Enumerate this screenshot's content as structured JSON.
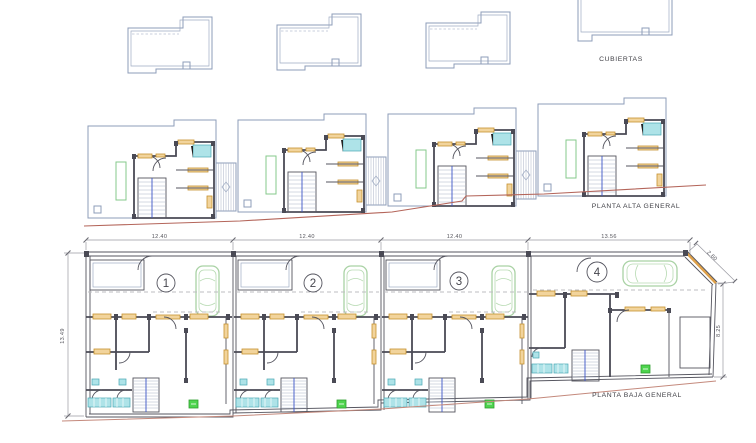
{
  "drawing": {
    "labels": {
      "roofs_plan": "CUBIERTAS",
      "upper_floor_plan": "PLANTA ALTA GENERAL",
      "ground_floor_plan": "PLANTA BAJA GENERAL"
    },
    "units": [
      "1",
      "2",
      "3",
      "4"
    ],
    "dimensions": {
      "unit_widths": [
        "12.40",
        "12.40",
        "12.40",
        "13.56"
      ],
      "left_depth": "13.49",
      "right_depth": "8.25",
      "chamfer": "2.60"
    },
    "icons": {
      "car": "top-view-car-outline",
      "stairs": "stair-tread-hatch",
      "unit_marker": "circled-number",
      "bath": "cyan-fixture",
      "planter": "green-rect-outline"
    },
    "colors": {
      "thin_line_blue": "#8e9cb8",
      "wall_dark": "#4a4a55",
      "lintel_orange": "#c6912f",
      "lintel_fill": "#f2d49c",
      "fixture_cyan": "#aee3e8",
      "car_green": "#a9d2a4",
      "marker_green": "#4ed44e",
      "terrain_red": "#b4655a",
      "stair_rail_blue": "#3c55c8",
      "dimension_gray": "#9a9aa2"
    }
  }
}
